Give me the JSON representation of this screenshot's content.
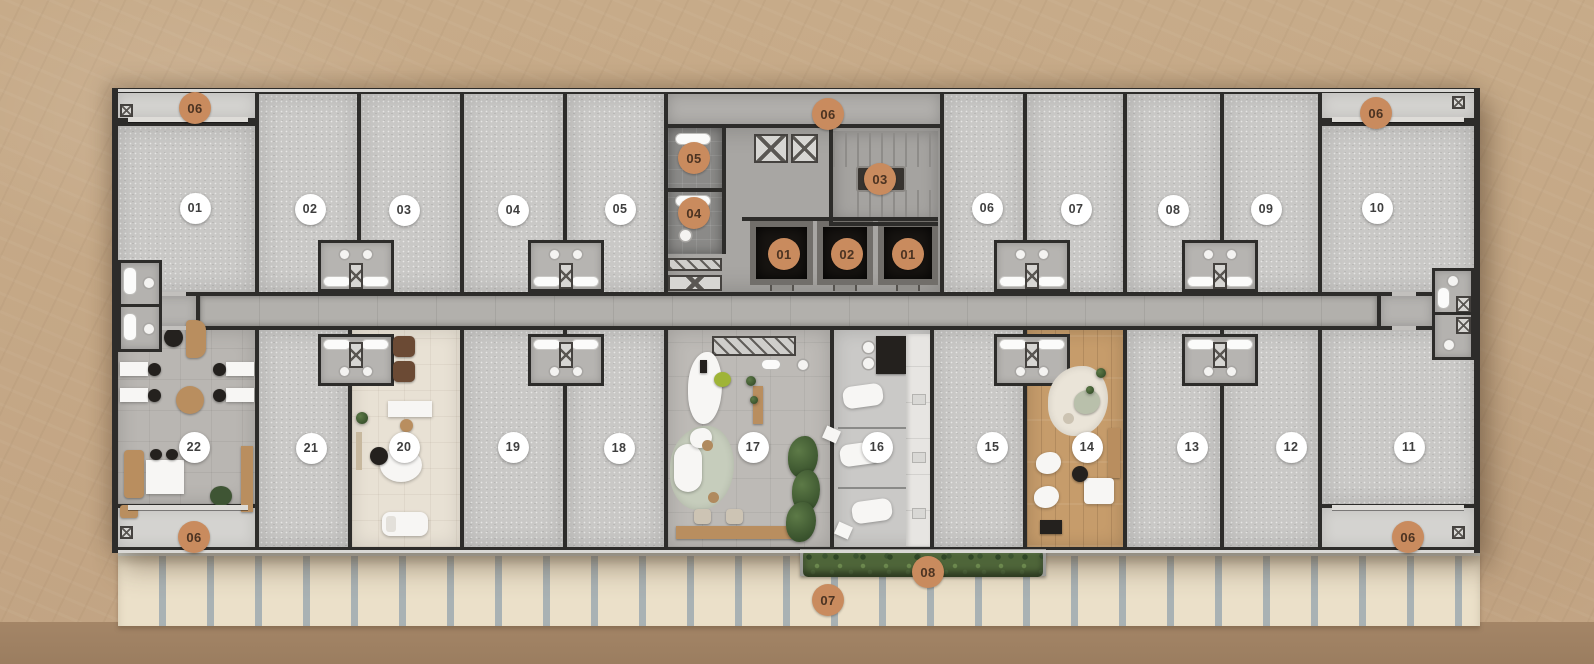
{
  "floorplan": {
    "description_label": "",
    "units": [
      {
        "label": "01",
        "x": 195,
        "y": 208
      },
      {
        "label": "02",
        "x": 310,
        "y": 209
      },
      {
        "label": "03",
        "x": 404,
        "y": 210
      },
      {
        "label": "04",
        "x": 513,
        "y": 210
      },
      {
        "label": "05",
        "x": 620,
        "y": 209
      },
      {
        "label": "06",
        "x": 987,
        "y": 208
      },
      {
        "label": "07",
        "x": 1076,
        "y": 209
      },
      {
        "label": "08",
        "x": 1173,
        "y": 210
      },
      {
        "label": "09",
        "x": 1266,
        "y": 209
      },
      {
        "label": "10",
        "x": 1377,
        "y": 208
      },
      {
        "label": "11",
        "x": 1409,
        "y": 447
      },
      {
        "label": "12",
        "x": 1291,
        "y": 447
      },
      {
        "label": "13",
        "x": 1192,
        "y": 447
      },
      {
        "label": "14",
        "x": 1087,
        "y": 447
      },
      {
        "label": "15",
        "x": 992,
        "y": 447
      },
      {
        "label": "16",
        "x": 877,
        "y": 447
      },
      {
        "label": "17",
        "x": 753,
        "y": 447
      },
      {
        "label": "18",
        "x": 619,
        "y": 448
      },
      {
        "label": "19",
        "x": 513,
        "y": 447
      },
      {
        "label": "20",
        "x": 404,
        "y": 447
      },
      {
        "label": "21",
        "x": 311,
        "y": 448
      },
      {
        "label": "22",
        "x": 194,
        "y": 447
      }
    ],
    "key_badges": [
      {
        "label": "06",
        "x": 195,
        "y": 108,
        "name": "terrace-top-left"
      },
      {
        "label": "06",
        "x": 828,
        "y": 114,
        "name": "core-hall"
      },
      {
        "label": "06",
        "x": 1376,
        "y": 113,
        "name": "terrace-top-right"
      },
      {
        "label": "05",
        "x": 694,
        "y": 158,
        "name": "wc-upper"
      },
      {
        "label": "04",
        "x": 694,
        "y": 213,
        "name": "wc-lower"
      },
      {
        "label": "03",
        "x": 880,
        "y": 179,
        "name": "stairs"
      },
      {
        "label": "01",
        "x": 784,
        "y": 254,
        "name": "elevator-left"
      },
      {
        "label": "02",
        "x": 847,
        "y": 254,
        "name": "elevator-middle"
      },
      {
        "label": "01",
        "x": 908,
        "y": 254,
        "name": "elevator-right"
      },
      {
        "label": "06",
        "x": 194,
        "y": 537,
        "name": "terrace-bottom-left"
      },
      {
        "label": "06",
        "x": 1408,
        "y": 537,
        "name": "terrace-bottom-right"
      },
      {
        "label": "08",
        "x": 928,
        "y": 572,
        "name": "hedge-planter"
      },
      {
        "label": "07",
        "x": 828,
        "y": 600,
        "name": "sidewalk"
      }
    ],
    "colors": {
      "wall": "#2d2c2a",
      "room_floor": "#c9c8c6",
      "corridor_floor": "#b2b0ac",
      "core_floor": "#a8a6a3",
      "balcony_floor": "#d4d3d0",
      "wood_floor": "#c69c6b",
      "cream_floor": "#e8e1d4",
      "office_floor": "#b9b6b2",
      "lounge_floor": "#bdbab6",
      "clinic_floor": "#cac9c7",
      "background": "#c7ab89",
      "background_lower": "#b19171",
      "sidewalk": "#ebe0c9",
      "sidewalk_joint": "#a9b2b4",
      "hedge": "#4e6539",
      "badge_orange": "#c98b5e",
      "badge_orange_text": "#4b3322",
      "badge_white": "#ffffff",
      "badge_white_text": "#3e3e3e",
      "elevator_cab": "#181512",
      "elevator_frame": "#716e6a",
      "wood_furniture": "#b98e5f",
      "dark_furniture": "#24211e"
    }
  }
}
